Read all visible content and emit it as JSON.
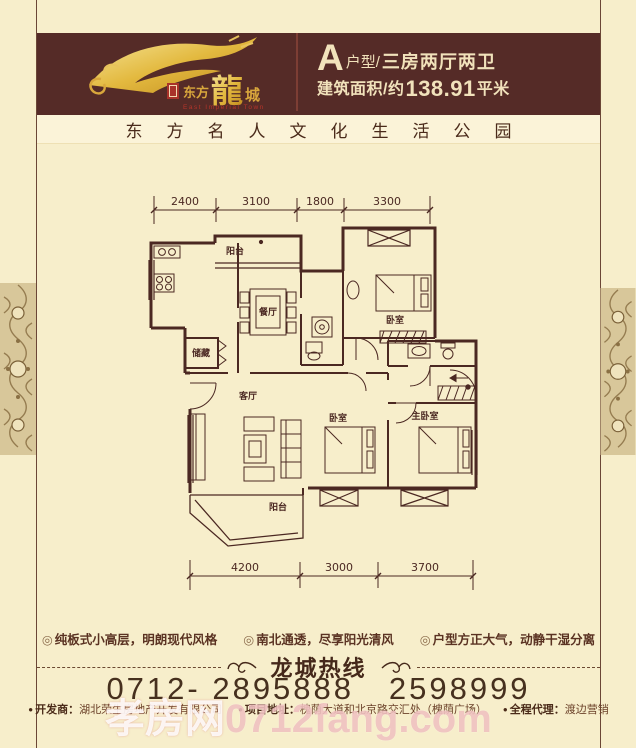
{
  "header": {
    "unit_letter": "A",
    "unit_suffix": "户型/",
    "unit_rooms": "三房两厅两卫",
    "area_prefix": "建筑面积/约",
    "area_value": "138.91",
    "area_suffix": "平米",
    "logo": {
      "name_pre": "东方",
      "name_big": "龍",
      "name_post": "城",
      "en": "East Imperial Town"
    }
  },
  "tagline": "东方名人文化生活公园",
  "floor_plan": {
    "dims_top": [
      "2400",
      "3100",
      "1800",
      "3300"
    ],
    "dims_bottom": [
      "4200",
      "3000",
      "3700"
    ],
    "rooms": {
      "balcony_top": "阳台",
      "dining": "餐厅",
      "bedroom_top_right": "卧室",
      "storage": "储藏",
      "living": "客厅",
      "balcony_bottom": "阳台",
      "bedroom_middle": "卧室",
      "master_bedroom": "主卧室"
    }
  },
  "features": [
    "纯板式小高层，明朗现代风格",
    "南北通透，尽享阳光清风",
    "户型方正大气，动静干湿分离"
  ],
  "ui": {
    "feature_bullet": "◎",
    "footer_bullet": "●"
  },
  "hotline": {
    "title": "龙城热线",
    "phone": "0712- 2895888   2598999"
  },
  "footer": {
    "items": [
      {
        "label": "开发商：",
        "value": "湖北荣生房地产开发有限公司"
      },
      {
        "label": "项目地址：",
        "value": "槐荫大道和北京路交汇处（槐荫广场）"
      },
      {
        "label": "全程代理：",
        "value": "渡边营销"
      }
    ]
  },
  "watermark": {
    "part1": "孝房网",
    "part2": "0712fang.com"
  },
  "colors": {
    "header_bg": "#552b27",
    "page_bg": "#f7eecb",
    "band_bg": "#fbf3d8",
    "gold": "#d8a93c",
    "seal_red": "#a8322a",
    "plan_line": "#4b2822"
  }
}
